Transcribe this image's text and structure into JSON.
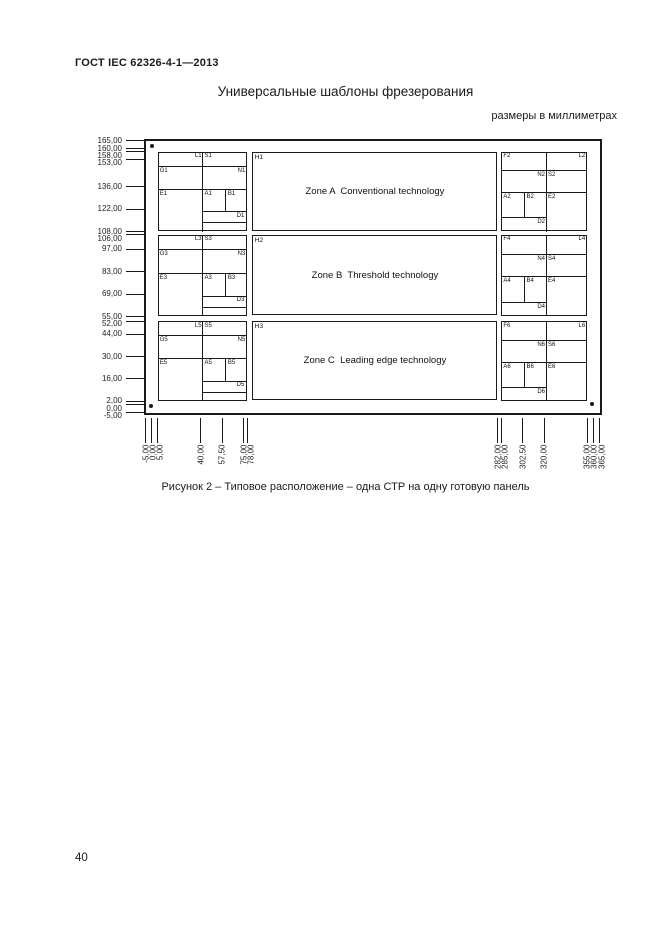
{
  "page": {
    "doc_number": "ГОСТ IEC 62326-4-1—2013",
    "title": "Универсальные шаблоны фрезерования",
    "units_note": "размеры в миллиметрах",
    "caption": "Рисунок 2 – Типовое расположение – одна СТР на одну готовую панель",
    "page_number": "40"
  },
  "diagram": {
    "line_color": "#1a1a1a",
    "board_mm": {
      "x0": -5,
      "x1": 365,
      "y0": -5,
      "y1": 165
    },
    "y_axis_ticks": [
      {
        "mm": 165,
        "label": "165,00"
      },
      {
        "mm": 160,
        "label": "160,00"
      },
      {
        "mm": 158,
        "label": "158,00"
      },
      {
        "mm": 153,
        "label": "153,00"
      },
      {
        "mm": 136,
        "label": "136,00"
      },
      {
        "mm": 122,
        "label": "122,00"
      },
      {
        "mm": 108,
        "label": "108,00"
      },
      {
        "mm": 106,
        "label": "106,00"
      },
      {
        "mm": 97,
        "label": "97,00"
      },
      {
        "mm": 83,
        "label": "83,00"
      },
      {
        "mm": 69,
        "label": "69,00"
      },
      {
        "mm": 55,
        "label": "55,00"
      },
      {
        "mm": 52,
        "label": "52,00"
      },
      {
        "mm": 44,
        "label": "44,00"
      },
      {
        "mm": 30,
        "label": "30,00"
      },
      {
        "mm": 16,
        "label": "16,00"
      },
      {
        "mm": 2,
        "label": "2,00"
      },
      {
        "mm": 0,
        "label": "0,00"
      },
      {
        "mm": -5,
        "label": "-5,00"
      }
    ],
    "x_axis_ticks": [
      {
        "mm": -5,
        "label": "-5,00"
      },
      {
        "mm": 0,
        "label": "0,00"
      },
      {
        "mm": 5,
        "label": "5,00"
      },
      {
        "mm": 40,
        "label": "40,00"
      },
      {
        "mm": 57.5,
        "label": "57,50"
      },
      {
        "mm": 75,
        "label": "75,00"
      },
      {
        "mm": 78,
        "label": "78,00"
      },
      {
        "mm": 282,
        "label": "282,00"
      },
      {
        "mm": 285,
        "label": "285,00"
      },
      {
        "mm": 302.5,
        "label": "302,50"
      },
      {
        "mm": 320,
        "label": "320,00"
      },
      {
        "mm": 355,
        "label": "355,00"
      },
      {
        "mm": 360,
        "label": "360,00"
      },
      {
        "mm": 365,
        "label": "365,00"
      }
    ],
    "columns_mm": {
      "left_coupon": {
        "x0": 5,
        "x1": 78
      },
      "zone": {
        "x0": 82,
        "x1": 282
      },
      "right_coupon": {
        "x0": 285,
        "x1": 355
      }
    },
    "rows_mm": [
      {
        "top": 158,
        "bottom": 108
      },
      {
        "top": 106,
        "bottom": 55
      },
      {
        "top": 52,
        "bottom": 2
      }
    ],
    "zones": [
      {
        "corner_label": "H1",
        "label": "Zone A  Conventional technology"
      },
      {
        "corner_label": "H2",
        "label": "Zone B  Threshold technology"
      },
      {
        "corner_label": "H3",
        "label": "Zone C  Leading edge technology"
      }
    ],
    "coupon_panels": [
      {
        "side": "left",
        "row": 0,
        "labels": [
          "L1",
          "S1",
          "G1",
          "N1",
          "E1",
          "A1",
          "B1",
          "D1"
        ]
      },
      {
        "side": "right",
        "row": 0,
        "labels": [
          "F2",
          "L2",
          "N2",
          "S2",
          "A2",
          "B2",
          "E2",
          "D2"
        ]
      },
      {
        "side": "left",
        "row": 1,
        "labels": [
          "L3",
          "S3",
          "G3",
          "N3",
          "E3",
          "A3",
          "B3",
          "D3"
        ]
      },
      {
        "side": "right",
        "row": 1,
        "labels": [
          "F4",
          "L4",
          "N4",
          "S4",
          "A4",
          "B4",
          "E4",
          "D4"
        ]
      },
      {
        "side": "left",
        "row": 2,
        "labels": [
          "L5",
          "S5",
          "G5",
          "N5",
          "E5",
          "A5",
          "B5",
          "D5"
        ]
      },
      {
        "side": "right",
        "row": 2,
        "labels": [
          "F6",
          "L6",
          "N6",
          "S6",
          "A6",
          "B6",
          "E6",
          "D6"
        ]
      }
    ],
    "fiducials_px": [
      [
        152,
        146
      ],
      [
        151,
        406
      ],
      [
        592,
        404
      ]
    ]
  }
}
